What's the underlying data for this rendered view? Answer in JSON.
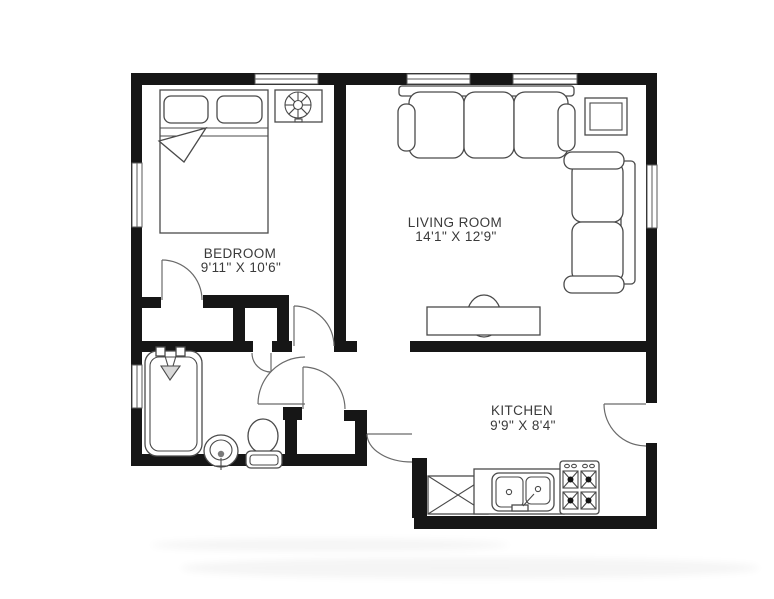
{
  "floor_plan": {
    "title": "one-bedroom apartment floor plan",
    "colors": {
      "background": "#ffffff",
      "wall": "#161616",
      "furniture_line": "#4a4a4a",
      "label_text": "#3a3a3a"
    },
    "rooms": {
      "bedroom": {
        "name": "BEDROOM",
        "dimensions": "9'11\" X 10'6\"",
        "fixtures": [
          "double-bed",
          "ceiling-fan",
          "closet",
          "window"
        ]
      },
      "living_room": {
        "name": "LIVING ROOM",
        "dimensions": "14'1\" X 12'9\"",
        "fixtures": [
          "sofa",
          "loveseat",
          "coffee-table",
          "end-table",
          "windows"
        ]
      },
      "kitchen": {
        "name": "KITCHEN",
        "dimensions": "9'9\" X 8'4\"",
        "fixtures": [
          "counter",
          "double-sink",
          "stove",
          "appliance-box",
          "entry-door"
        ]
      },
      "bathroom": {
        "name": "",
        "dimensions": "",
        "fixtures": [
          "bathtub-with-shower",
          "sink",
          "toilet",
          "window"
        ]
      }
    },
    "counts": {
      "windows": 6,
      "door_swings": 7
    }
  }
}
